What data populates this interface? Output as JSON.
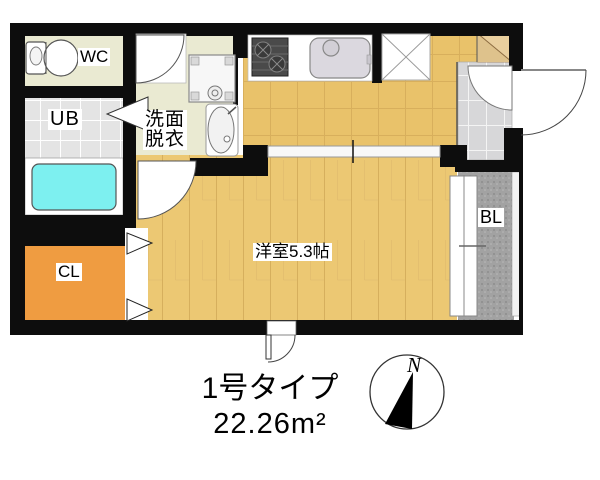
{
  "plan": {
    "rooms": {
      "wc": "WC",
      "unit_bath": "UB",
      "washroom": [
        "洗面",
        "脱衣"
      ],
      "closet": "CL",
      "main_room": "洋室5.3帖",
      "balcony": "BL"
    },
    "caption": {
      "type": "1号タイプ",
      "area": "22.26m²"
    },
    "compass": {
      "north": "N"
    },
    "colors": {
      "wall": "#0d0d0d",
      "room_beige": "#eaead2",
      "ub_tile": "#e4e4e4",
      "bathtub_cyan": "#7df0f0",
      "closet_orange": "#ef9c41",
      "wood_floor": "#ecc873",
      "kitchen_floor": "#e9c26a",
      "entry_tile": "#d7d7d9",
      "entry_step": "#e9cf9e",
      "balcony_gray": "#a2a2a2"
    }
  }
}
